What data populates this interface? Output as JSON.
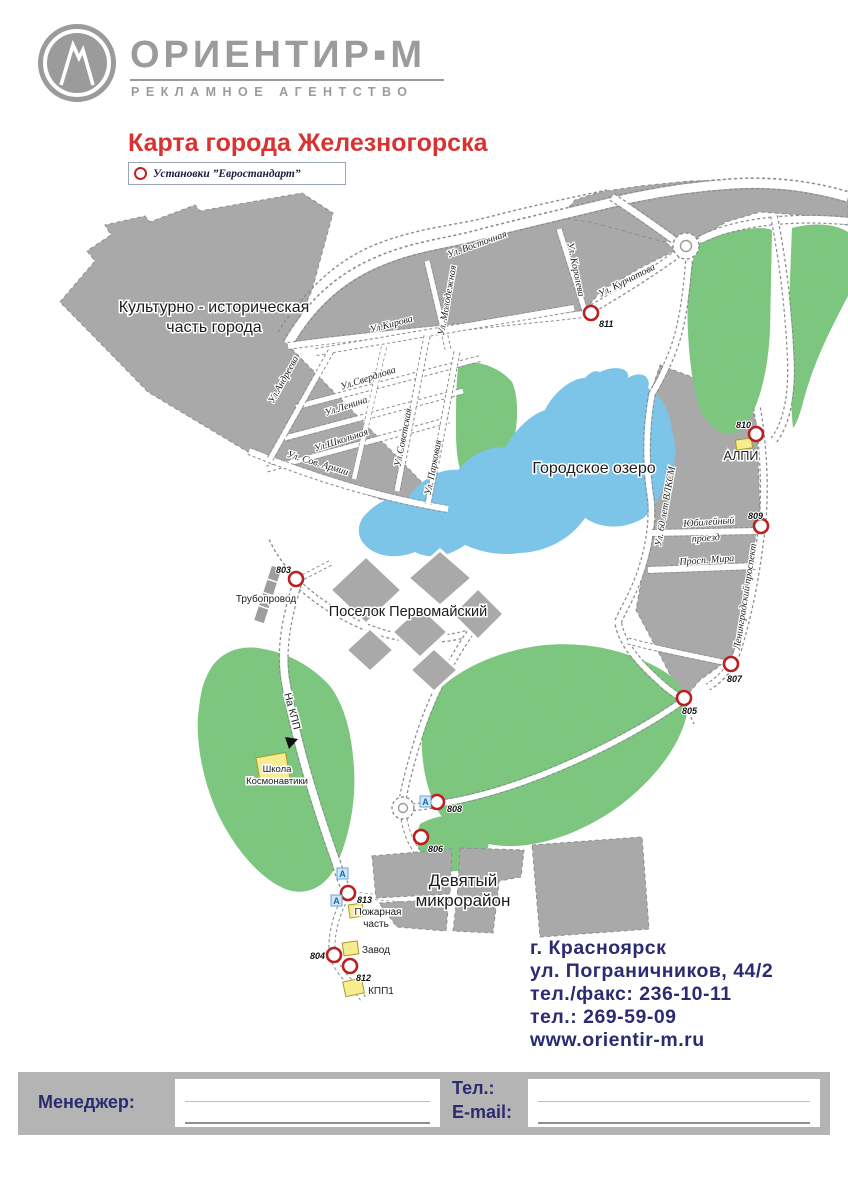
{
  "header": {
    "brand": "ОРИЕНТИР▪М",
    "tagline": "РЕКЛАМНОЕ АГЕНТСТВО",
    "title": "Карта города Железногорска",
    "legend_label": "Установки ”Евростандарт”"
  },
  "map": {
    "areas": {
      "historic_line1": "Культурно - историческая",
      "historic_line2": "часть города",
      "lake": "Городское озеро",
      "pervomaisky": "Поселок Первомайский",
      "ninth_line1": "Девятый",
      "ninth_line2": "микрорайон",
      "alpi": "АЛПИ"
    },
    "streets": {
      "vostochnaya": "Ул. Восточная",
      "kurchatova": "Ул. Курчатова",
      "koroleva": "Ул. Королева",
      "molodezhnaya": "Ул. Молодежная",
      "kirova": "Ул.Кирова",
      "sverdlova": "Ул.Свердлова",
      "lenina": "Ул.Ленина",
      "shkolnaya": "Ул.Школьная",
      "sov_armii": "Ул. Сов. Армии",
      "andreeva": "Ул.Андреева",
      "sovetskaya": "Ул.Советская",
      "parkovaya": "Ул. Парковая",
      "vlksm": "Ул. 60 лет ВЛКСМ",
      "yubileyny_line1": "Юбилейный",
      "yubileyny_line2": "проезд",
      "mira": "Просп. Мира",
      "leningradsky": "Ленинградский проспект"
    },
    "pois": {
      "pipeline": "Трубопровод",
      "school_line1": "Школа",
      "school_line2": "Космонавтики",
      "fire_line1": "Пожарная",
      "fire_line2": "часть",
      "zavod": "Завод",
      "kpp1": "КПП1",
      "to_kpp": "На КПП"
    },
    "marker_a": "А",
    "points": [
      {
        "num": "811"
      },
      {
        "num": "810"
      },
      {
        "num": "809"
      },
      {
        "num": "807"
      },
      {
        "num": "805"
      },
      {
        "num": "803"
      },
      {
        "num": "808"
      },
      {
        "num": "806"
      },
      {
        "num": "813"
      },
      {
        "num": "804"
      },
      {
        "num": "812"
      }
    ]
  },
  "contact": {
    "city": "г. Красноярск",
    "address": "ул. Пограничников, 44/2",
    "telfax": "тел./факс: 236-10-11",
    "tel": "тел.: 269-59-09",
    "site": "www.orientir-m.ru"
  },
  "footer": {
    "manager_label": "Менеджер:",
    "tel_label": "Тел.:",
    "email_label": "E-mail:"
  },
  "colors": {
    "accent_red": "#D93232",
    "brand_gray": "#9B9B9B",
    "navy": "#2B2B72",
    "block_gray": "#A9A9A9",
    "forest_green": "#7CC77C",
    "lake_blue": "#7DC4E9"
  }
}
